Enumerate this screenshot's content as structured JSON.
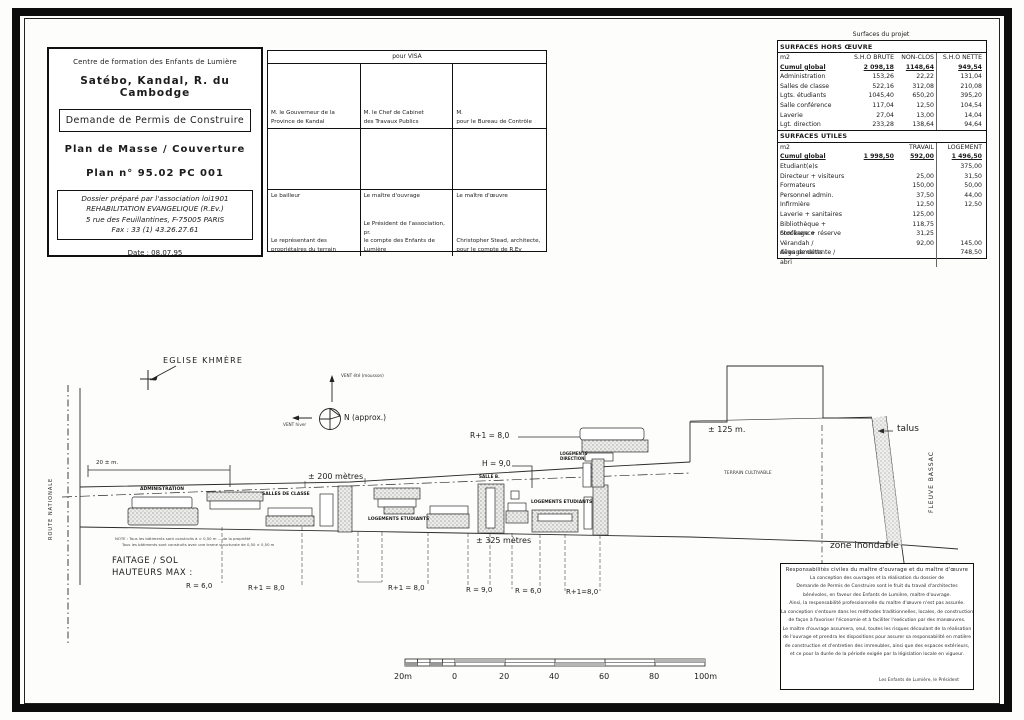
{
  "title_block": {
    "org": "Centre de formation des Enfants de Lumière",
    "location": "Satébo, Kandal, R. du Cambodge",
    "permit": "Demande de Permis de Construire",
    "plan_name": "Plan de Masse / Couverture",
    "plan_no": "Plan n° 95.02 PC 001",
    "dossier": [
      "Dossier préparé par l'association loi1901",
      "REHABILITATION EVANGELIQUE (R.Ev.)",
      "5 rue des Feuillantines, F-75005 PARIS",
      "Fax : 33 (1) 43.26.27.61"
    ],
    "date": "Date : 08.07.95"
  },
  "visa": {
    "header": "pour  VISA",
    "row1": [
      "M. le Gouverneur de la\nProvince de Kandal",
      "M. le Chef de Cabinet\ndes Travaux Publics",
      "M.\npour le Bureau de Contrôle"
    ],
    "row3_top": [
      "Le bailleur",
      "Le maître d'ouvrage",
      "Le maître d'œuvre"
    ],
    "row3_bottom": [
      "Le représentant des\npropriétaires du terrain",
      "Le Président de l'association, pr.\nle compte des Enfants de Lumière",
      "Christopher Stead, architecte,\npour le compte de R.Ev"
    ]
  },
  "surfaces": {
    "caption": "Surfaces  du projet",
    "hors_oeuvre": {
      "title": "SURFACES HORS ŒUVRE",
      "unit": "m2",
      "cols": [
        "S.H.O BRUTE",
        "NON-CLOS",
        "S.H.O NETTE"
      ],
      "cumul": {
        "label": "Cumul  global",
        "brute": "2 098,18",
        "non_clos": "1148,64",
        "nette": "949,54"
      },
      "rows": [
        {
          "label": "Administration",
          "brute": "153,26",
          "non_clos": "22,22",
          "nette": "131,04"
        },
        {
          "label": "Salles de classe",
          "brute": "522,16",
          "non_clos": "312,08",
          "nette": "210,08"
        },
        {
          "label": "Lgts. étudiants",
          "brute": "1045,40",
          "non_clos": "650,20",
          "nette": "395,20"
        },
        {
          "label": "Salle conférence",
          "brute": "117,04",
          "non_clos": "12,50",
          "nette": "104,54"
        },
        {
          "label": "Laverie",
          "brute": "27,04",
          "non_clos": "13,00",
          "nette": "14,04"
        },
        {
          "label": "Lgt. direction",
          "brute": "233,28",
          "non_clos": "138,64",
          "nette": "94,64"
        }
      ]
    },
    "utiles": {
      "title": "SURFACES UTILES",
      "unit": "m2",
      "cols": [
        "TRAVAIL",
        "LOGEMENT"
      ],
      "cumul": {
        "label": "Cumul  global",
        "total": "1 998,50",
        "travail": "592,00",
        "logement": "1 496,50"
      },
      "rows": [
        {
          "label": "Etudiant(e)s",
          "travail": "",
          "logement": "375,00"
        },
        {
          "label": "Directeur + visiteurs",
          "travail": "25,00",
          "logement": "31,50"
        },
        {
          "label": "Formateurs",
          "travail": "150,00",
          "logement": "50,00"
        },
        {
          "label": "Personnel admin.",
          "travail": "37,50",
          "logement": "44,00"
        },
        {
          "label": "Infirmière",
          "travail": "12,50",
          "logement": "12,50"
        },
        {
          "label": "Laverie + sanitaires",
          "travail": "125,00",
          "logement": ""
        },
        {
          "label": "Bibliothèque + conférence",
          "travail": "118,75",
          "logement": ""
        },
        {
          "label": "Stockage + réserve",
          "travail": "31,25",
          "logement": ""
        },
        {
          "label": "Vérandah / dégagements",
          "travail": "92,00",
          "logement": "145,00"
        },
        {
          "label": "Aires de détente / abri",
          "travail": "",
          "logement": "748,50"
        }
      ]
    }
  },
  "drawing": {
    "labels": {
      "eglise": "EGLISE KHMÈRE",
      "north": "N (approx.)",
      "vent_ete": "VENT été (mousson)",
      "vent_hiver": "VENT hiver",
      "route": "ROUTE  NATIONALE",
      "fleuve": "FLEUVE  BASSAC",
      "dim20": "20 ± m.",
      "dim200": "± 200 mètres",
      "dim325": "± 325 mètres",
      "dim125": "± 125 m.",
      "administration": "ADMINISTRATION",
      "salles": "SALLES DE CLASSE",
      "lgts1": "LOGEMENTS ETUDIANTS",
      "lgts2": "LOGEMENTS ETUDIANTS",
      "salle_b": "SALLE B.",
      "lgt_dir": "LOGEMENTS\nDIRECTION",
      "terrain": "TERRAIN CULTIVABLE",
      "talus": "talus",
      "zone": "zone inondable",
      "r1_top": "R+1 = 8,0",
      "h9": "H = 9,0",
      "faitage": "FAITAGE / SOL\nHAUTEURS MAX :",
      "h_r6a": "R = 6,0",
      "h_r1a": "R+1 = 8,0",
      "h_r1b": "R+1 = 8,0",
      "h_r9": "R = 9,0",
      "h_r6b": "R = 6,0",
      "h_r1c": "R+1=8,0",
      "note_line1": "NOTE : Tous les bâtiments sont construits à > 0,50 m ... de la propriété",
      "note_line2": "Tous les bâtiments sont construits avec une trame structurale de 0,50 × 0,50 m"
    },
    "scale_bar": {
      "labels": [
        "20m",
        "0",
        "20",
        "40",
        "60",
        "80",
        "100m"
      ]
    }
  },
  "responsibility": {
    "title": "Responsabilités civiles du maître d'ouvrage et du maître d'œuvre",
    "lines": [
      "La conception des ouvrages et la réalisation du dossier de",
      "Demande de Permis de Construire sont le fruit du travail d'architectes",
      "bénévoles, en faveur des Enfants de Lumière, maître d'ouvrage.",
      "Ainsi, la responsabilité professionnelle du maître d'œuvre n'est pas assurée.",
      "La conception s'entoure dans les méthodes traditionnelles, locales, de construction",
      "de façon à favoriser l'économie et à faciliter l'exécution par des manœuvres.",
      "Le maître d'ouvrage assumera, seul, toutes les risques découlant de la réalisation",
      "de l'ouvrage et prendra les dispositions pour assurer sa responsabilité en matière",
      "de construction et d'entretien des immeubles, ainsi que des espaces extérieurs,",
      "et ce pour la durée de la période exigée par la législation locale en vigueur."
    ],
    "signature": "Les Enfants de Lumière, le Président"
  }
}
